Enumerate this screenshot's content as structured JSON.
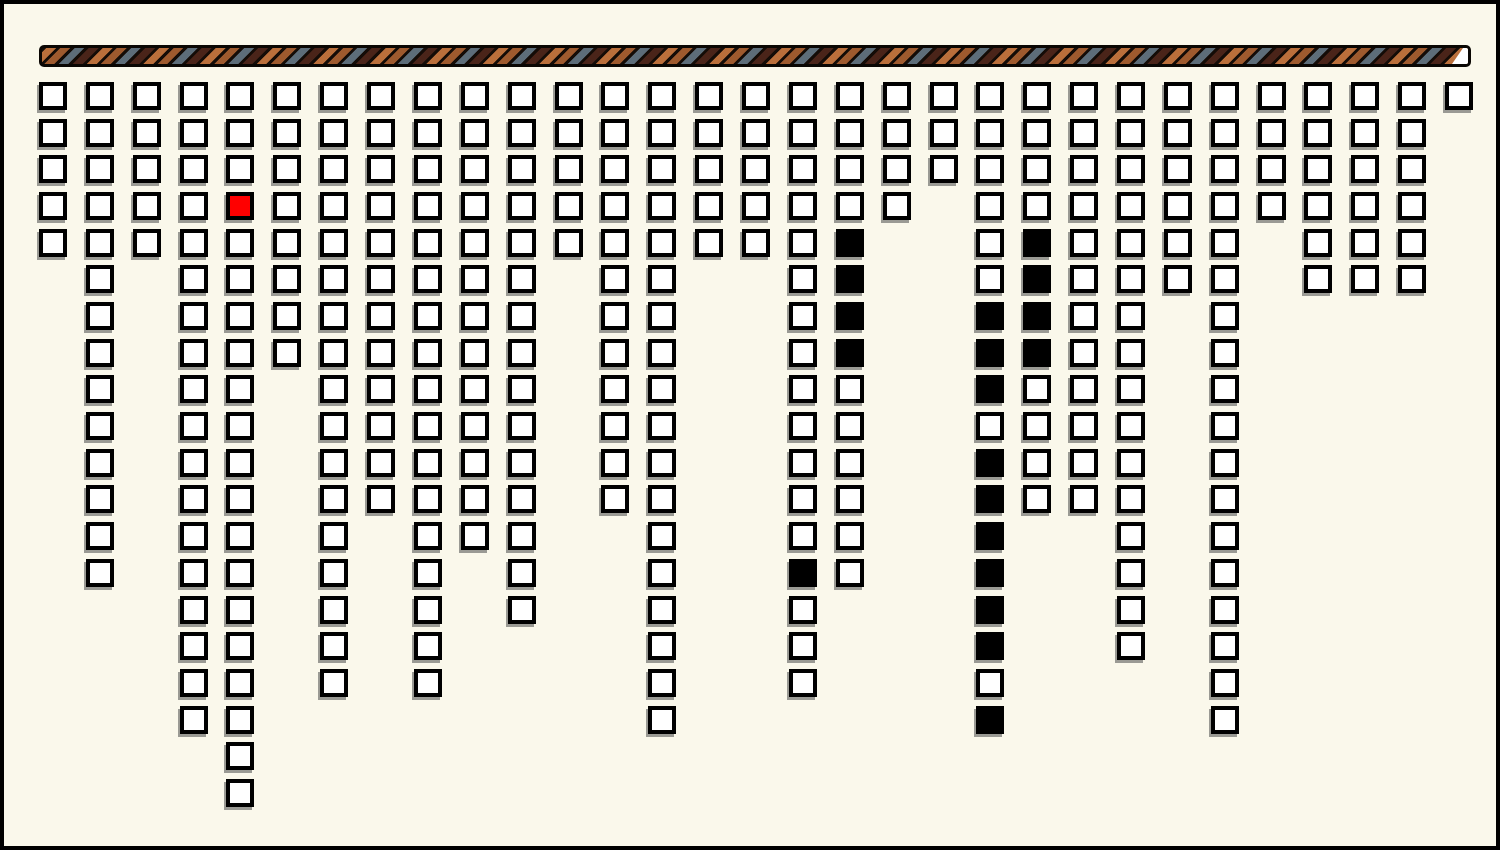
{
  "colors": {
    "window_background": "#FAF8EB",
    "frame_border": "#000000",
    "cell_outline": "#000000",
    "cell_fill_white": "#FFFFFF",
    "cell_fill_black": "#000000",
    "cell_fill_red": "#FF0000",
    "cell_shadow": "#9A9A94",
    "stripe_orange": "#BA6F3B",
    "stripe_brown": "#9E5A2E",
    "stripe_slate": "#5D6D79",
    "stripe_maroon": "#4A2419",
    "stripe_separator": "#140C07",
    "progress_tip": "#FFFFFF"
  },
  "progress_bar": {
    "x": 35,
    "y": 41,
    "width": 1432,
    "height": 22,
    "tip_width": 16,
    "state": "nearly-full"
  },
  "grid": {
    "origin_x": 35,
    "origin_y": 78,
    "col_pitch": 46.87,
    "row_pitch": 36.68,
    "cell_size": 28,
    "cols": 31,
    "rows": 20,
    "legend": {
      "w": "white-outline-block",
      "b": "black-filled-block",
      "r": "red-filled-block",
      ".": "empty"
    },
    "columns": [
      "wwwww...............",
      "wwwwwwwwwwwwww......",
      "wwwww...............",
      "wwwwwwwwwwwwwwwwww..",
      "wwwrwwwwwwwwwwwwwwww",
      "wwwwwwww............",
      "wwwwwwwwwwwwwwwww...",
      "wwwwwwwwwwww........",
      "wwwwwwwwwwwwwwwww...",
      "wwwwwwwwwwwww.......",
      "wwwwwwwwwwwwwww.....",
      "wwwww...............",
      "wwwwwwwwwwww........",
      "wwwwwwwwwwwwwwwwww..",
      "wwwww...............",
      "wwwww...............",
      "wwwwwwwwwwwwwbwww...",
      "wwwwbbbbwwwwww......",
      "wwww................",
      "www.................",
      "wwwwwwbbbwbbbbbbwb..",
      "wwwwbbbbwwww........",
      "wwwwwwwwwwww........",
      "wwwwwwwwwwwwwwww....",
      "wwwwww..............",
      "wwwwwwwwwwwwwwwwww..",
      "wwww................",
      "wwwwww..............",
      "wwwwww..............",
      "wwwwww..............",
      "w..................."
    ]
  }
}
